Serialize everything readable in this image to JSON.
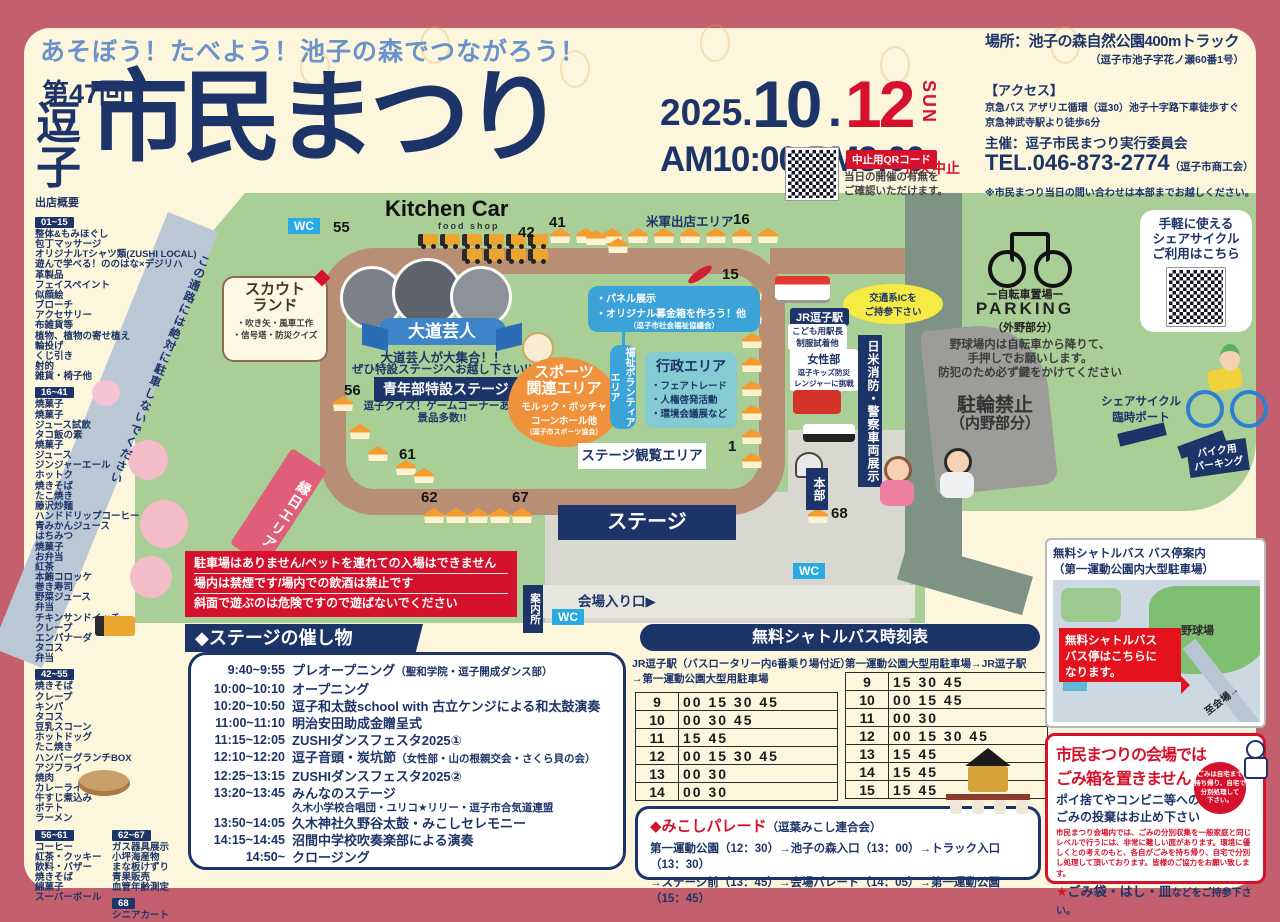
{
  "header": {
    "subtitle": "あそぼう！たべよう！池子の森でつながろう！",
    "edition": "第47回",
    "title_left": "逗子",
    "title_main": "市民まつり",
    "date": {
      "year": "2025.",
      "month": "10",
      "dot": ".",
      "day": "12",
      "dow": "SUN"
    },
    "time": "AM10:00-PM3:00",
    "cancel_note": "荒天中止",
    "qr": {
      "label": "中止用QRコード",
      "note1": "当日の開催の有無を",
      "note2": "ご確認いただけます。"
    },
    "place": {
      "line": "場所：池子の森自然公園400mトラック",
      "addr": "（逗子市池子字花ノ瀬60番1号）"
    },
    "access": {
      "title": "【アクセス】",
      "line1": "京急バス アザリエ循環（逗30）池子十字路下車徒歩すぐ",
      "line2": "京急神武寺駅より徒歩6分"
    },
    "host": "主催：逗子市民まつり実行委員会",
    "tel": "TEL.046-873-2774",
    "tel_org": "（逗子市商工会）",
    "contact": "※市民まつり当日の問い合わせは本部までお越しください。"
  },
  "vendors": {
    "title": "出店概要",
    "groups": [
      {
        "range": "01~15",
        "items": [
          "整体&もみほぐし",
          "包丁マッサージ",
          "オリジナルTシャツ類(ZUSHI LOCAL)",
          "遊んで学べる！ののはな×デジリハ",
          "革製品",
          "フェイスペイント",
          "似顔絵",
          "ブローチ",
          "アクセサリー",
          "布雑貨等",
          "植物、植物の寄せ植え",
          "輪投げ",
          "くじ引き",
          "射的",
          "雑貨・椅子他"
        ]
      },
      {
        "range": "16~41",
        "items": [
          "焼菓子",
          "焼菓子",
          "ジュース試飲",
          "タコ飯の素",
          "焼菓子",
          "ジュース",
          "ジンジャーエール",
          "ホットク",
          "焼きそば",
          "たこ焼き",
          "藤沢炒麺",
          "ハンドドリップコーヒー",
          "青みかんジュース",
          "はちみつ",
          "焼菓子",
          "お弁当",
          "紅茶",
          "本鮪コロッケ",
          "巻き寿司",
          "野菜ジュース",
          "弁当",
          "チキンサンドイッチ",
          "クレープ",
          "エンパナーダ",
          "タコス",
          "弁当"
        ]
      },
      {
        "range": "42~55",
        "items": [
          "焼きそば",
          "クレープ",
          "キンパ",
          "タコス",
          "豆乳スコーン",
          "ホットドッグ",
          "たこ焼き",
          "ハンバーグランチBOX",
          "アジフライ",
          "焼肉",
          "カレーライス",
          "牛すじ煮込み",
          "ポテト",
          "ラーメン"
        ]
      },
      {
        "range": "56~61",
        "items": [
          "コーヒー",
          "紅茶・クッキー",
          "飲料・バザー",
          "焼きそば",
          "綿菓子",
          "スーパーボール"
        ]
      },
      {
        "range": "62~67",
        "items": [
          "ガス器具展示",
          "小坪海産物",
          "まな板けずり",
          "青果販売",
          "血管年齢測定"
        ]
      },
      {
        "range": "68",
        "items": [
          "シニアカート"
        ]
      }
    ]
  },
  "map": {
    "wc": "WC",
    "kitchen_car": "Kitchen Car",
    "food_shop": "food shop",
    "scout": {
      "title1": "スカウト",
      "title2": "ランド",
      "line1": "・吹き矢・風車工作",
      "line2": "・信号塔・防災クイズ"
    },
    "daidogei": {
      "banner": "大道芸人",
      "line1": "大道芸人が大集合！！",
      "line2": "ぜひ特設ステージへお越し下さい!!"
    },
    "seinenbu": {
      "banner": "青年部特設ステージ",
      "line1": "逗子クイズ！ゲームコーナーあり",
      "line2": "景品多数!!"
    },
    "sports": {
      "title1": "スポーツ",
      "title2": "関連エリア",
      "line1": "モルック・ボッチャ",
      "line2": "コーンホール他",
      "org": "（逗子市スポーツ協会）"
    },
    "fukushi": "福祉ボランティアエリア",
    "panel": {
      "line1": "・パネル展示",
      "line2": "・オリジナル募金箱を作ろう！他",
      "org": "（逗子市社会福祉協議会）"
    },
    "gyosei": {
      "title": "行政エリア",
      "line1": "・フェアトレード",
      "line2": "・人権啓発活動",
      "line3": "・環境会議展など"
    },
    "beigun": "米軍出店エリア",
    "ic_note1": "交通系ICを",
    "ic_note2": "ご持参下さい",
    "jr": {
      "title": "JR逗子駅",
      "sub1": "こども用駅長",
      "sub2": "制服試着他"
    },
    "josei": {
      "title": "女性部",
      "sub1": "逗子キッズ防災",
      "sub2": "レンジャーに挑戦"
    },
    "shobo": "日米消防・警察車両展示",
    "kanran": "ステージ観覧エリア",
    "stage": "ステージ",
    "ennichi": "縁日エリア",
    "honbu": "本部",
    "annai": "案内所",
    "entrance": "会場入り口▶",
    "road_note": "この通路には絶対に駐車しないでください",
    "numbers": {
      "n55": "55",
      "n42": "42",
      "n41": "41",
      "n16": "16",
      "n15": "15",
      "n1": "1",
      "n56": "56",
      "n61": "61",
      "n62": "62",
      "n67": "67",
      "n68": "68"
    }
  },
  "bike": {
    "share": {
      "line1": "手軽に使える",
      "line2": "シェアサイクル",
      "line3": "ご利用はこちら"
    },
    "parking": {
      "jp": "ー自転車置場ー",
      "en": "PARKING",
      "note": "（外野部分）"
    },
    "rule1": "野球場内は自転車から降りて、",
    "rule2": "手押しでお願いします。",
    "rule3": "防犯のため必ず鍵をかけてください",
    "no_parking1": "駐輪禁止",
    "no_parking2": "（内野部分）",
    "port1": "シェアサイクル",
    "port2": "臨時ポート",
    "moto1": "バイク用",
    "moto2": "パーキング"
  },
  "warnings": {
    "line1": "駐車場はありません/ペットを連れての入場はできません",
    "line2": "場内は禁煙です/場内での飲酒は禁止です",
    "line3": "斜面で遊ぶのは危険ですので遊ばないでください"
  },
  "stage_events": {
    "title": "◆ステージの催し物",
    "items": [
      {
        "time": "9:40~9:55",
        "name": "プレオープニング",
        "note": "（聖和学院・逗子開成ダンス部）"
      },
      {
        "time": "10:00~10:10",
        "name": "オープニング"
      },
      {
        "time": "10:20~10:50",
        "name": "逗子和太鼓school with 古立ケンジによる和太鼓演奏"
      },
      {
        "time": "11:00~11:10",
        "name": "明治安田助成金贈呈式"
      },
      {
        "time": "11:15~12:05",
        "name": "ZUSHIダンスフェスタ2025①"
      },
      {
        "time": "12:10~12:20",
        "name": "逗子音頭・炭坑節",
        "note": "（女性部・山の根親交会・さくら貝の会）"
      },
      {
        "time": "12:25~13:15",
        "name": "ZUSHIダンスフェスタ2025②"
      },
      {
        "time": "13:20~13:45",
        "name": "みんなのステージ",
        "sub": "久木小学校合唱団・ユリコ★リリー・逗子市合気道連盟"
      },
      {
        "time": "13:50~14:05",
        "name": "久木神社久野谷太鼓・みこしセレモニー"
      },
      {
        "time": "14:15~14:45",
        "name": "沼間中学校吹奏楽部による演奏"
      },
      {
        "time": "14:50~",
        "name": "クロージング"
      }
    ]
  },
  "shuttle": {
    "title": "無料シャトルバス時刻表",
    "left": {
      "caption1": "JR逗子駅（バスロータリー内6番乗り場付近）",
      "caption2": "→第一運動公園大型用駐車場",
      "rows": [
        [
          "9",
          "00 15 30 45"
        ],
        [
          "10",
          "00 30 45"
        ],
        [
          "11",
          "15 45"
        ],
        [
          "12",
          "00 15 30 45"
        ],
        [
          "13",
          "00 30"
        ],
        [
          "14",
          "00 30"
        ]
      ]
    },
    "right": {
      "caption": "第一運動公園大型用駐車場→JR逗子駅",
      "rows": [
        [
          "9",
          "15 30 45"
        ],
        [
          "10",
          "00 15 45"
        ],
        [
          "11",
          "00 30"
        ],
        [
          "12",
          "00 15 30 45"
        ],
        [
          "13",
          "15 45"
        ],
        [
          "14",
          "15 45"
        ],
        [
          "15",
          "15 45"
        ]
      ]
    }
  },
  "mikoshi": {
    "title": "◆みこしパレード",
    "org": "（逗葉みこし連合会）",
    "line1": "第一運動公園（12：30）→池子の森入口（13：00）→トラック入口（13：30）",
    "line2": "→ステージ前（13：45）→会場パレード（14：05）→第一運動公園（15：45）"
  },
  "bus_map": {
    "title1": "無料シャトルバス バス停案内",
    "title2": "（第一運動公園内大型駐車場）",
    "field": "野球場",
    "callout1": "無料シャトルバス",
    "callout2": "バス停はこちらに",
    "callout3": "なります。",
    "arrow": "至会場→"
  },
  "trash": {
    "title1": "市民まつりの会場では",
    "title2": "ごみ箱を置きません",
    "sub1": "ポイ捨てやコンビニ等への",
    "sub2": "ごみの投棄はお止め下さい",
    "circle1": "ごみは自宅まで",
    "circle2": "持ち帰り、自宅で",
    "circle3": "分別処理して",
    "circle4": "下さい。",
    "body": "市民まつり会場内では、ごみの分別収集を一般家庭と同じレベルで行うには、非常に難しい面があります。環境に優しくとの考えのもと、各自がごみを持ち帰り、自宅で分別し処理して頂いております。皆様のご協力をお願い致します。",
    "star": "★",
    "footer1": "ごみ袋・はし・皿",
    "footer2": "などをご持参下さい。"
  },
  "colors": {
    "navy": "#1d3468",
    "red": "#d5112b",
    "cream": "#fcf6dc",
    "rose": "#c4606d",
    "map_green": "#a9ce96",
    "track_brown": "#b88e74",
    "sky_blue": "#29abe2",
    "bubble_blue": "#3ba3d8",
    "teal": "#84cbd2",
    "orange": "#f0923c",
    "pink": "#df5f79",
    "yellow": "#f6ea44"
  }
}
